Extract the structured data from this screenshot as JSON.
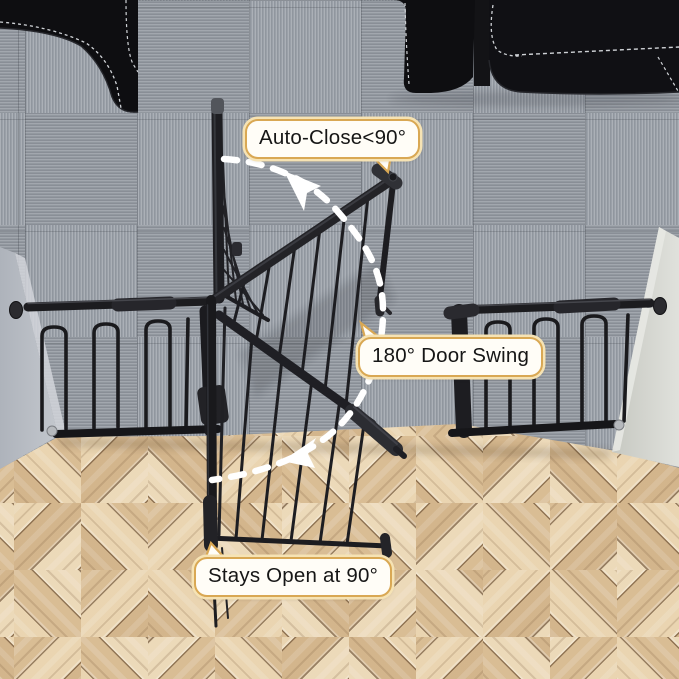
{
  "annotations": {
    "auto_close": "Auto-Close<90°",
    "door_swing": "180° Door Swing",
    "stays_open": "Stays Open at 90°"
  },
  "scene": {
    "subject": "black metal pressure-mounted safety gate in doorway shown in three swing positions",
    "rooms": [
      "gray carpet-tile room",
      "herringbone wood-floor room"
    ],
    "furniture": [
      "black sofa corner top-left",
      "black sofa top-right"
    ]
  },
  "colors": {
    "accent": "#d9a854",
    "accent_halo": "#f6e3b4",
    "bubble_bg": "#fffdf7",
    "gate_black": "#1b1b1f",
    "arrow_white": "#ffffff",
    "carpet": "#9aa0a8",
    "wood_base": "#e2cba6",
    "wall_left": "#b8bdc4",
    "wall_right": "#d7d8d2",
    "couch_black": "#0e0e11"
  }
}
